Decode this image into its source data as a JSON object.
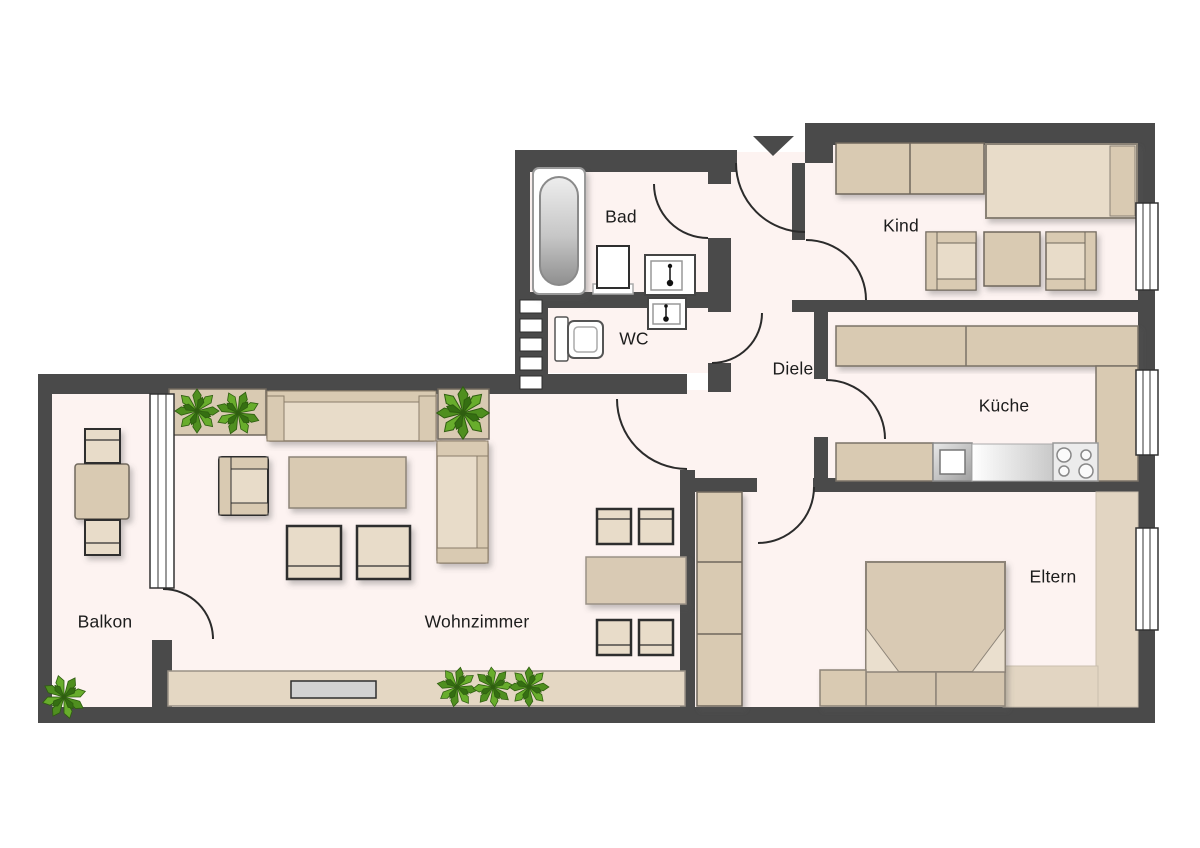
{
  "title": "Wohnung Grundriss",
  "rooms": [
    {
      "id": "bad",
      "label": "Bad"
    },
    {
      "id": "wc",
      "label": "WC"
    },
    {
      "id": "diele",
      "label": "Diele"
    },
    {
      "id": "kind",
      "label": "Kind"
    },
    {
      "id": "kueche",
      "label": "Küche"
    },
    {
      "id": "eltern",
      "label": "Eltern"
    },
    {
      "id": "wohnzimmer",
      "label": "Wohnzimmer"
    },
    {
      "id": "balkon",
      "label": "Balkon"
    }
  ],
  "colors": {
    "wall": "#4a4a4a",
    "floor": "#fdf3f1",
    "furn": "#d9cab2",
    "furnlight": "#e8dcc9",
    "carpet": "#e2d5c2",
    "plant": "#68ad2c",
    "outline": "#2e2e2e",
    "arc": "#2b2b2b"
  }
}
